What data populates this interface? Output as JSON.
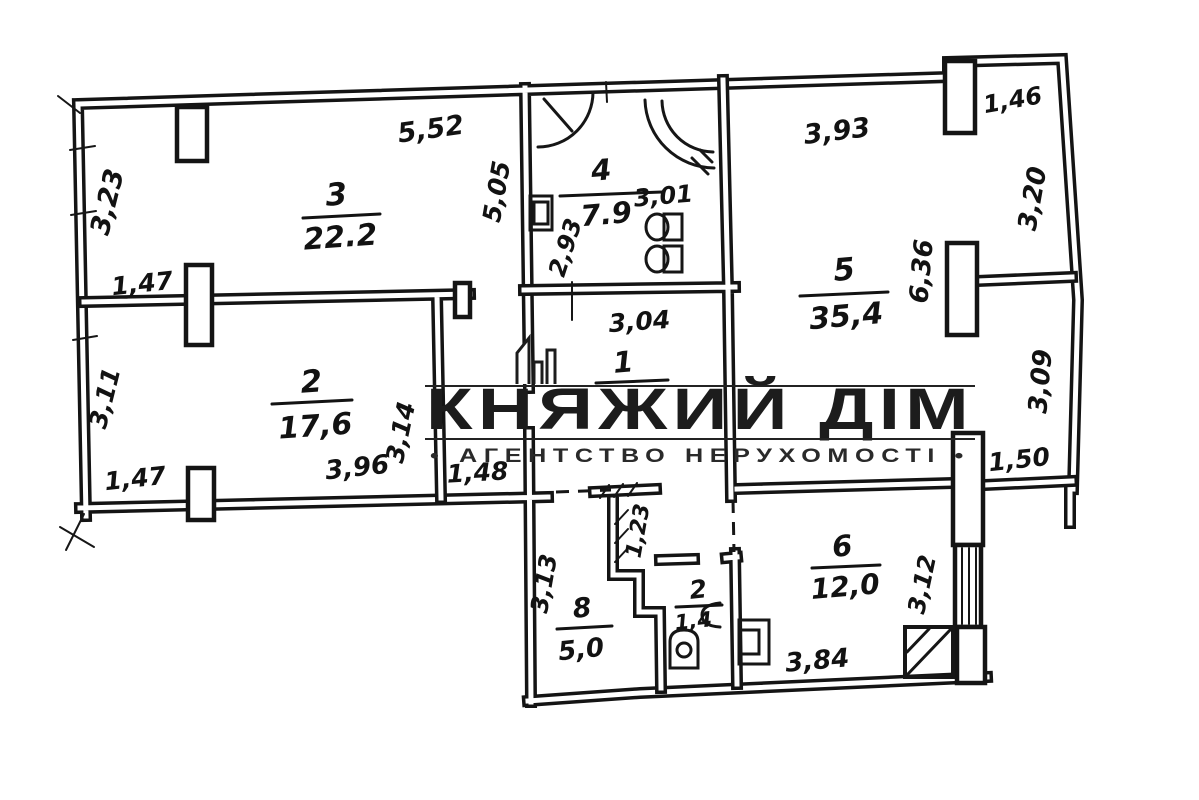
{
  "watermark": {
    "title": "КНЯЖИЙ ДІМ",
    "subtitle": "•  АГЕНТСТВО НЕРУХОМОСТІ  •"
  },
  "rooms": [
    {
      "id": "room-3",
      "number": "3",
      "area": "22.2"
    },
    {
      "id": "room-4-bath",
      "number": "4",
      "area": "7.9"
    },
    {
      "id": "room-5",
      "number": "5",
      "area": "35,4"
    },
    {
      "id": "room-2",
      "number": "2",
      "area": "17,6"
    },
    {
      "id": "room-1-hall",
      "number": "1",
      "area": ""
    },
    {
      "id": "room-6",
      "number": "6",
      "area": "12,0"
    },
    {
      "id": "room-8",
      "number": "8",
      "area": "5,0"
    },
    {
      "id": "room-wc",
      "number": "2",
      "area": "1,4"
    }
  ],
  "dimensions": {
    "room3_top": "5,52",
    "room3_left": "3,23",
    "window_left_upper": "1,47",
    "room2_left": "3,11",
    "window_left_lower": "1,47",
    "bath_left_wall": "5,05",
    "bath_inner_height": "2,93",
    "bath_width": "3,01",
    "hall_width": "3,04",
    "room5_top": "3,93",
    "window_top_right": "1,46",
    "room5_right_upper": "3,20",
    "room5_column": "6,36",
    "room5_right_lower": "3,09",
    "room5_bottom_right": "1,50",
    "room2_bottom": "3,96",
    "room2_right": "3,14",
    "corridor_width": "1,48",
    "closet_depth": "1,23",
    "room8_left": "3,13",
    "room6_bottom": "3,84",
    "room6_right": "3,12"
  }
}
